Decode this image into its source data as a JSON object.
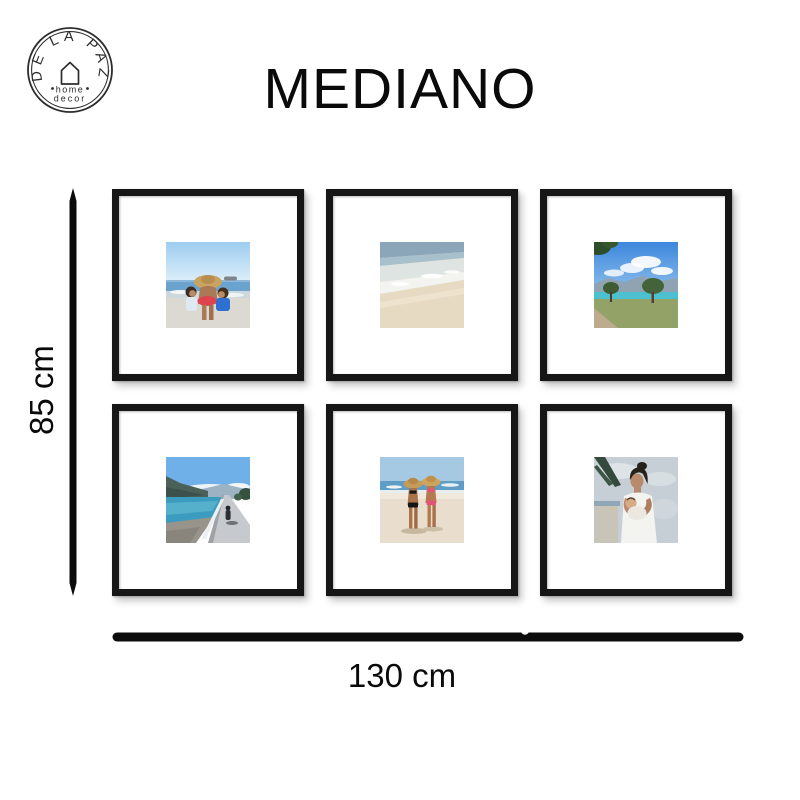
{
  "page": {
    "background": "#ffffff"
  },
  "logo": {
    "arc_text": "DE LA PAZ",
    "word1": "home",
    "word2": "decor",
    "icon": "house-outline-icon"
  },
  "title": "MEDIANO",
  "dimensions": {
    "height_label": "85 cm",
    "width_label": "130 cm"
  },
  "colors": {
    "frame": "#161616",
    "mat": "#ffffff",
    "dimension_line": "#0c0c0c",
    "text": "#0a0a0a",
    "logo_ink": "#2d2d2d"
  },
  "frames": [
    {
      "position": "top-left",
      "alt": "Family with mother in a straw hat and two children playing at the seashore"
    },
    {
      "position": "top-center",
      "alt": "Waves washing onto a sandy beach shoreline"
    },
    {
      "position": "top-right",
      "alt": "Lakeside park with trees, mountains, turquoise water and blue sky"
    },
    {
      "position": "bottom-left",
      "alt": "Person walking on a lakeside road with white guardrail and mountains"
    },
    {
      "position": "bottom-center",
      "alt": "Two women in sun hats and bikinis standing on a white sand beach"
    },
    {
      "position": "bottom-right",
      "alt": "Mother holding a baby at the beach beneath a palm leaf"
    }
  ]
}
